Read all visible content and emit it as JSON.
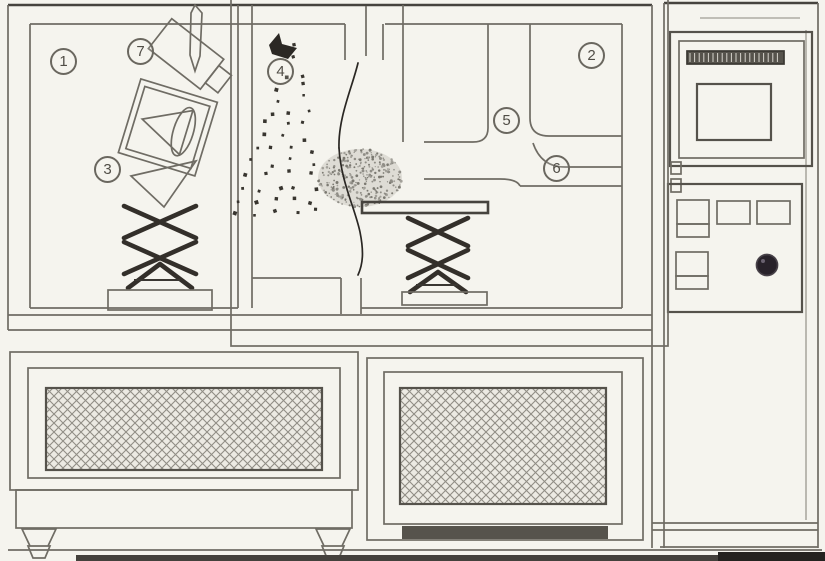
{
  "diagram": {
    "highlight_color": "#e60fbe",
    "labels": {
      "l1": "1",
      "l2": "2",
      "l3": "3",
      "l4": "4",
      "l5": "5",
      "l6": "6",
      "l7": "7"
    }
  }
}
